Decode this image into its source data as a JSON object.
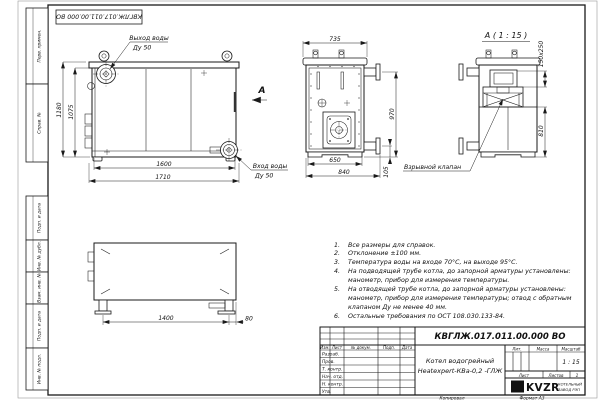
{
  "frame": {
    "top_stamp": "КВГЛЖ.017.011.00.000 ВО",
    "margin_labels": [
      "Перв. примен.",
      "Справ. №",
      "Подп. и дата",
      "Инв. № дубл.",
      "Взам. инв. №",
      "Подп. и дата",
      "Инв. № подл."
    ],
    "copied_label": "Копировал",
    "format_label": "Формат А3"
  },
  "front_view": {
    "outlet_label": "Выход воды",
    "outlet_dn": "Ду 50",
    "inlet_label": "Вход воды",
    "inlet_dn": "Ду 50",
    "dim_height_total": "1180",
    "dim_height_body": "1075",
    "dim_width_body": "1600",
    "dim_width_total": "1710",
    "section_letter": "А"
  },
  "side_view": {
    "dim_top_width": "735",
    "dim_bottom_width": "650",
    "dim_total_width": "840",
    "dim_height": "970",
    "dim_flange_offset": "105"
  },
  "detail_view": {
    "title": "А ( 1 : 15 )",
    "dim_valve_plate": "150х250",
    "dim_height": "810",
    "valve_label": "Взрывной клапан"
  },
  "bottom_view": {
    "dim_legs_span": "1400",
    "dim_leg_offset": "80"
  },
  "notes": {
    "items": [
      {
        "num": "1.",
        "text": "Все размеры для справок."
      },
      {
        "num": "2.",
        "text": "Отклонение ±100 мм."
      },
      {
        "num": "3.",
        "text": "Температура воды на входе 70°С, на выходе 95°С."
      },
      {
        "num": "4.",
        "text": "На подводящей трубе котла, до запорной арматуры установлены: манометр, прибор для измерения температуры."
      },
      {
        "num": "5.",
        "text": "На отводящей трубе котла, до запорной арматуры установлены: манометр, прибор для измерения температуры; отвод с обратным клапаном Ду не менее 40 мм."
      },
      {
        "num": "6.",
        "text": "Остальные требования по ОСТ 108.030.133-84."
      }
    ]
  },
  "title_block": {
    "doc_number": "КВГЛЖ.017.011.00.000 ВО",
    "product_name_line1": "Котел водогрейный",
    "product_name_line2": "Heatexpert-КВа-0,2 -ГЛЖ",
    "col_izm": "Изм.",
    "col_list": "Лист",
    "col_doc": "№ докум.",
    "col_podp": "Подп.",
    "col_data": "Дата",
    "row_razrab": "Разраб.",
    "row_prov": "Пров.",
    "row_tkontr": "Т. контр.",
    "row_nachotd": "Нач. отд.",
    "row_nkontr": "Н. контр.",
    "row_utv": "Утв.",
    "lit_label": "Лит.",
    "mass_label": "Масса",
    "scale_label": "Масштаб",
    "scale_value": "1 : 15",
    "sheet_label": "Лист",
    "sheets_label": "Листов",
    "sheets_value": "1",
    "logo_text": "KVZR",
    "company_line1": "КОТЕЛЬНЫЙ",
    "company_line2": "ЗАВОД РЭП"
  }
}
